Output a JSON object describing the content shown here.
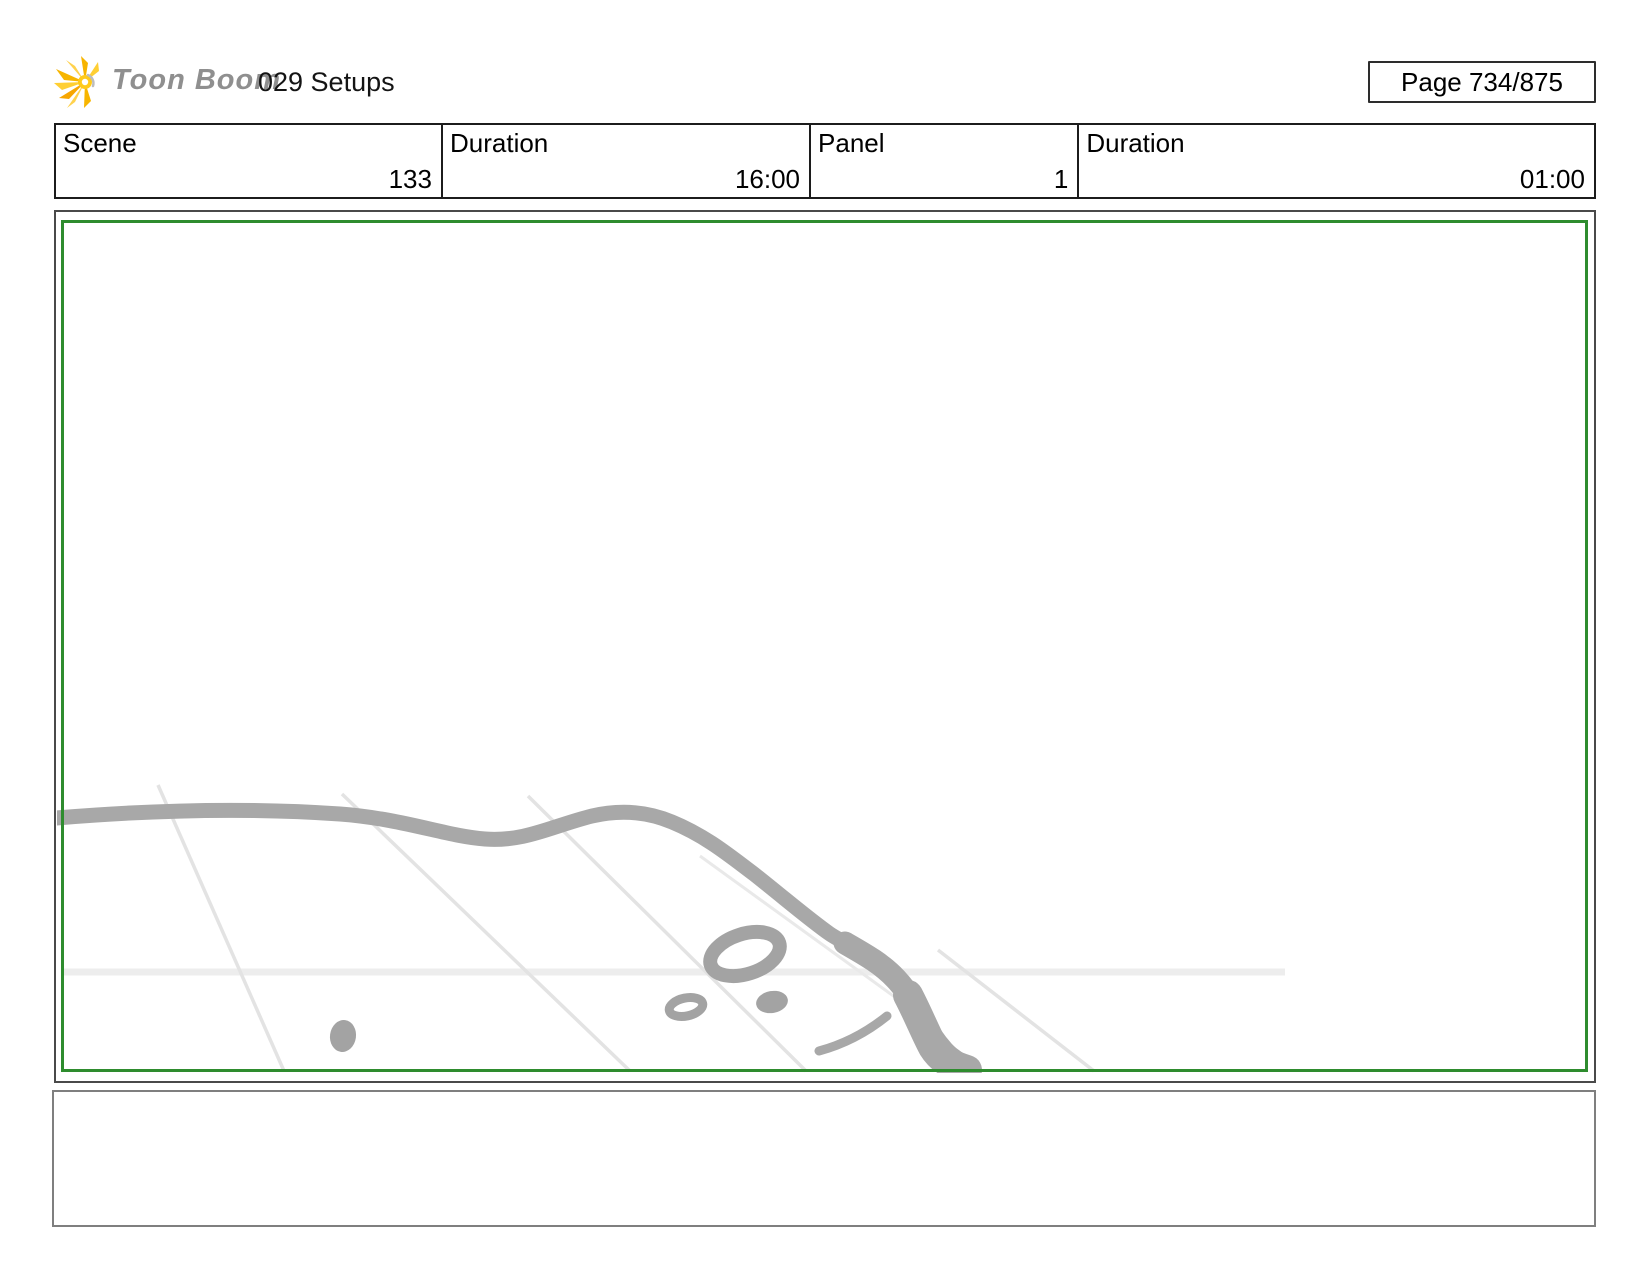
{
  "header": {
    "brand": "Toon Boom",
    "title": "029 Setups",
    "page_label": "Page 734/875"
  },
  "info_table": {
    "cells": [
      {
        "label": "Scene",
        "value": "133"
      },
      {
        "label": "Duration",
        "value": "16:00"
      },
      {
        "label": "Panel",
        "value": "1"
      },
      {
        "label": "Duration",
        "value": "01:00"
      }
    ]
  },
  "panel": {
    "frame_color": "#2e8c2e",
    "sketch_color": "#a8a8a8",
    "icon": "toonboom-sun-icon"
  },
  "caption": {
    "text": ""
  }
}
